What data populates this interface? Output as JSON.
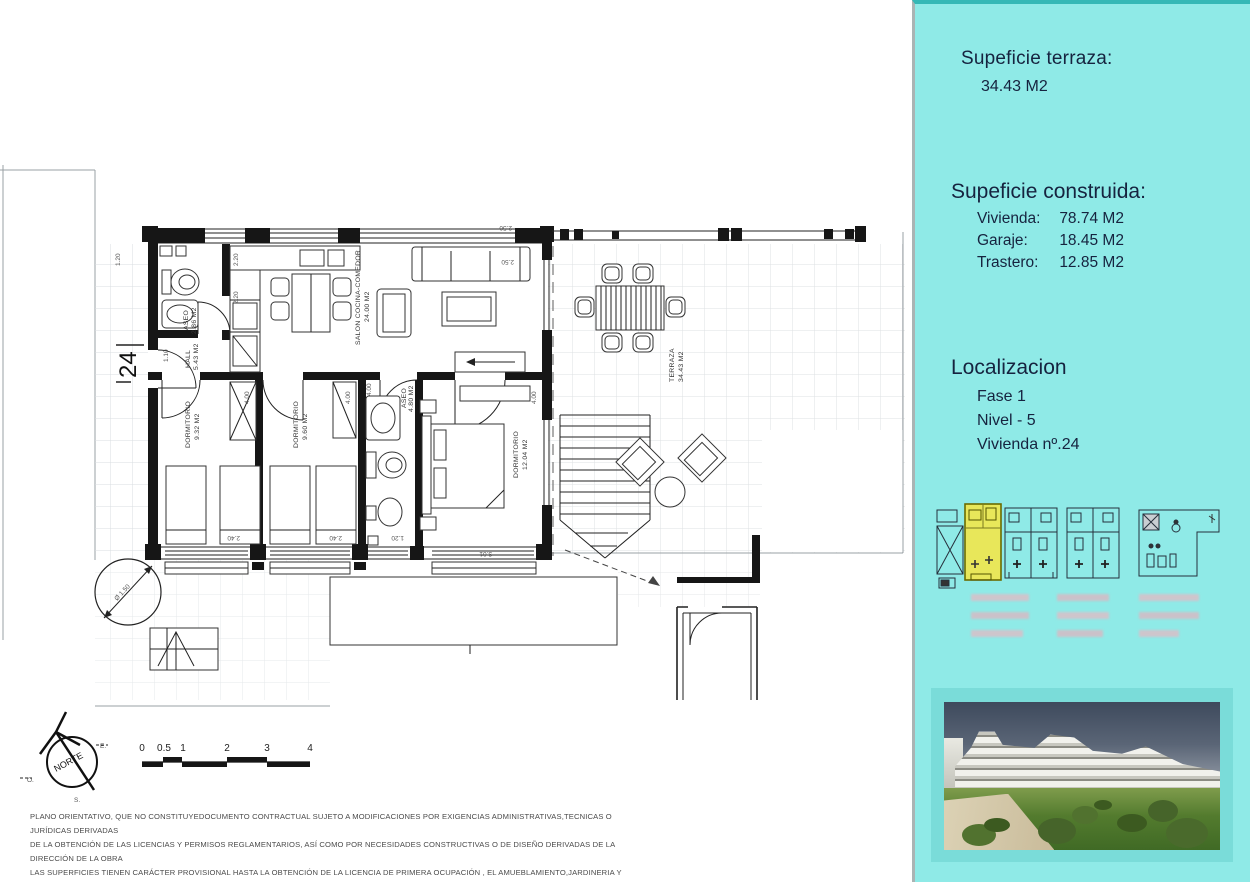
{
  "sidebar": {
    "bg_color": "#8feae7",
    "terraza_title": "Supeficie terraza:",
    "terraza_value": "34.43 M2",
    "construida_title": "Supeficie construida:",
    "construida_items": [
      {
        "label": "Vivienda:",
        "value": "78.74 M2"
      },
      {
        "label": "Garaje:",
        "value": "18.45 M2"
      },
      {
        "label": "Trastero:",
        "value": "12.85 M2"
      }
    ],
    "localizacion_title": "Localizacion",
    "localizacion_items": [
      "Fase 1",
      "Nivel - 5",
      "Vivienda nº.24"
    ],
    "highlight_color": "#e8e75a"
  },
  "plan": {
    "unit_number": "24",
    "labels": {
      "aseo1_name": "ASEO",
      "aseo1_area": "2.86 M2",
      "hall_name": "HALL",
      "hall_area": "5.43 M2",
      "salon_name": "SALON COCINA-COMEDOR",
      "salon_area": "24.00 M2",
      "dorm1_name": "DORMITORIO",
      "dorm1_area": "9.32 M2",
      "dorm2_name": "DORMITORIO",
      "dorm2_area": "9.60 M2",
      "aseo2_name": "ASEO",
      "aseo2_area": "4.80 M2",
      "dorm3_name": "DORMITORIO",
      "dorm3_area": "12.04 M2",
      "terraza_name": "TERRAZA",
      "terraza_area": "34.43 M2"
    },
    "dims": {
      "d120_top": "1.20",
      "d220_a": "2.20",
      "d220_b": "2.20",
      "d110": "1.10",
      "d400": "4.00",
      "d240": "2.40",
      "d120_b": "1.20",
      "d301": "3.01",
      "d250": "2.50",
      "diam": "Ø 1.50"
    },
    "compass": {
      "norte": "NORTE",
      "e": "E.",
      "o": "O.",
      "s": "S."
    },
    "scale_labels": [
      "0",
      "0.5",
      "1",
      "2",
      "3",
      "4"
    ]
  },
  "disclaimer": {
    "lines": [
      "PLANO ORIENTATIVO, QUE NO CONSTITUYEDOCUMENTO CONTRACTUAL SUJETO A MODIFICACIONES POR EXIGENCIAS ADMINISTRATIVAS,TECNICAS O JURÍDICAS DERIVADAS",
      "DE LA OBTENCIÓN DE LAS LICENCIAS Y PERMISOS REGLAMENTARIOS, ASÍ COMO POR NECESIDADES CONSTRUCTIVAS  O DE DISEÑO DERIVADAS DE LA DIRECCIÓN DE LA OBRA",
      "LAS SUPERFICIES TIENEN CARÁCTER PROVISIONAL HASTA LA OBTENCIÓN DE LA LICENCIA DE PRIMERA OCUPACIÓN , EL AMUEBLAMIENTO,JARDINERIA Y MOBILIARIO URBANO",
      "SON FICTICIOS,TENIENDO VALIDEZ ÚNICAMENTE  A EFECTOS DECORATIVOS"
    ]
  }
}
